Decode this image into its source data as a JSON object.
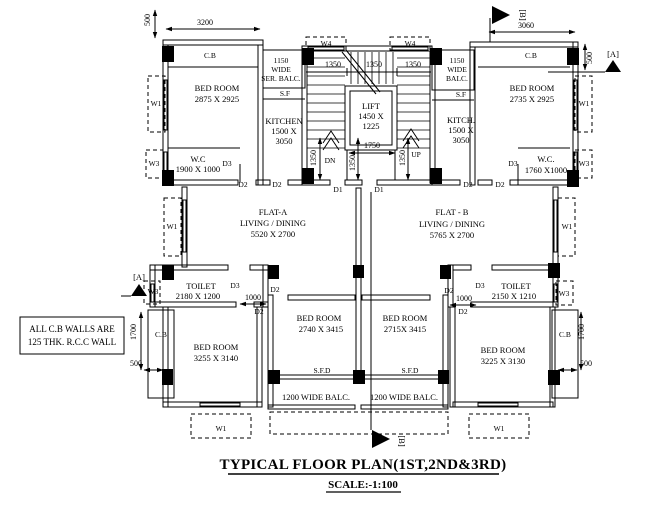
{
  "title": "TYPICAL FLOOR PLAN(1ST,2ND&3RD)",
  "scale": "SCALE:-1:100",
  "note": [
    "ALL C.B WALLS ARE",
    "125 THK. R.C.C WALL"
  ],
  "flat_a": {
    "name": "FLAT-A",
    "room": "LIVING / DINING",
    "size": "5520 X 2700"
  },
  "flat_b": {
    "name": "FLAT - B",
    "room": "LIVING / DINING",
    "size": "5765 X 2700"
  },
  "rooms": {
    "bed_top_left": {
      "name": "BED ROOM",
      "size": "2875 X 2925"
    },
    "bed_top_right": {
      "name": "BED ROOM",
      "size": "2735 X 2925"
    },
    "bed_bottom_left": {
      "name": "BED ROOM",
      "size": "3255 X 3140"
    },
    "bed_bottom_center_left": {
      "name": "BED ROOM",
      "size": "2740 X 3415"
    },
    "bed_bottom_center_right": {
      "name": "BED ROOM",
      "size": "2715X 3415"
    },
    "bed_bottom_right": {
      "name": "BED ROOM",
      "size": "3225 X 3130"
    },
    "wc_left": {
      "name": "W.C",
      "size": "1900 X 1000"
    },
    "wc_right": {
      "name": "W.C.",
      "size": "1760 X1000"
    },
    "toilet_left": {
      "name": "TOILET",
      "size": "2180 X 1200"
    },
    "toilet_right": {
      "name": "TOILET",
      "size": "2150 X 1210"
    },
    "kitchen_left": {
      "name": "KITCHEN",
      "size1": "1500 X",
      "size2": "3050"
    },
    "kitchen_right": {
      "name": "KITCH.",
      "size1": "1500 X",
      "size2": "3050"
    },
    "lift": {
      "name": "LIFT",
      "size1": "1450 X",
      "size2": "1225"
    },
    "ser_balc_left": [
      "1150",
      "WIDE",
      "SER. BALC."
    ],
    "balc_right": [
      "1150",
      "WIDE",
      "BALC."
    ],
    "balc_bottom": "1200 WIDE BALC."
  },
  "tags": {
    "cb": "C.B",
    "sf": "S.F",
    "sfd": "S.F.D",
    "w1": "W1",
    "w3": "W3",
    "w4": "W4",
    "d1": "D1",
    "d2": "D2",
    "d3": "D3",
    "dn": "DN",
    "up": "UP"
  },
  "dims": {
    "w3200": "3200",
    "w3060": "3060",
    "d500": "500",
    "d1350": "1350",
    "d1750": "1750",
    "d1000": "1000",
    "d1700": "1700"
  },
  "markers": {
    "a": "[A]",
    "b": "[B]"
  }
}
